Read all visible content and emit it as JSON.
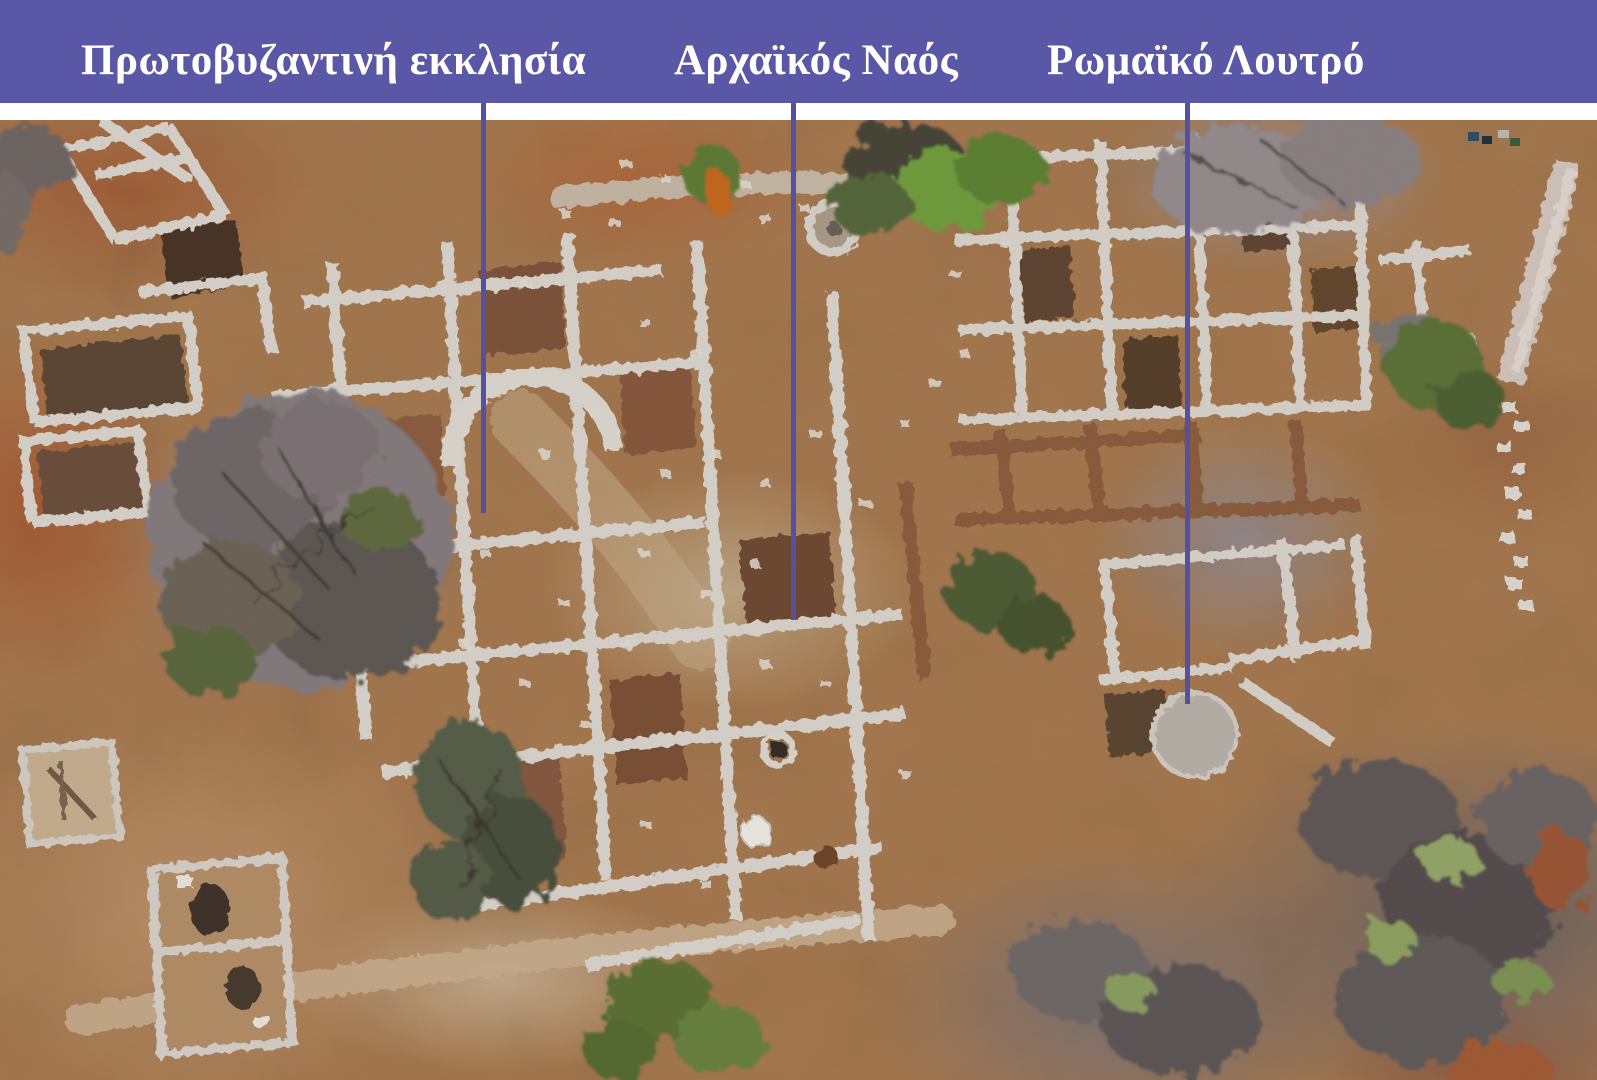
{
  "banner": {
    "background_color": "#5a57a6",
    "text_color": "#ffffff",
    "labels": [
      {
        "id": "early-byzantine-church",
        "text": "Πρωτοβυζαντινή εκκλησία"
      },
      {
        "id": "archaic-temple",
        "text": "Αρχαϊκός Ναός"
      },
      {
        "id": "roman-bath",
        "text": "Ρωμαϊκό Λουτρό"
      }
    ]
  },
  "leader_lines": {
    "color": "#54519f"
  },
  "photo": {
    "type": "aerial-photograph-of-excavation",
    "palette": {
      "soil": "#a6794f",
      "rust_soil": "#a55f36",
      "stone_wall": "#d6d1c9",
      "pale_ground": "#c2aa8b",
      "scrub_gray": "#8f8489",
      "dark_scrub": "#5f5857",
      "vegetation_green": "#5d7a34",
      "excavation_dark": "#5c4634",
      "earth_baulk": "#8a5c3c"
    }
  }
}
